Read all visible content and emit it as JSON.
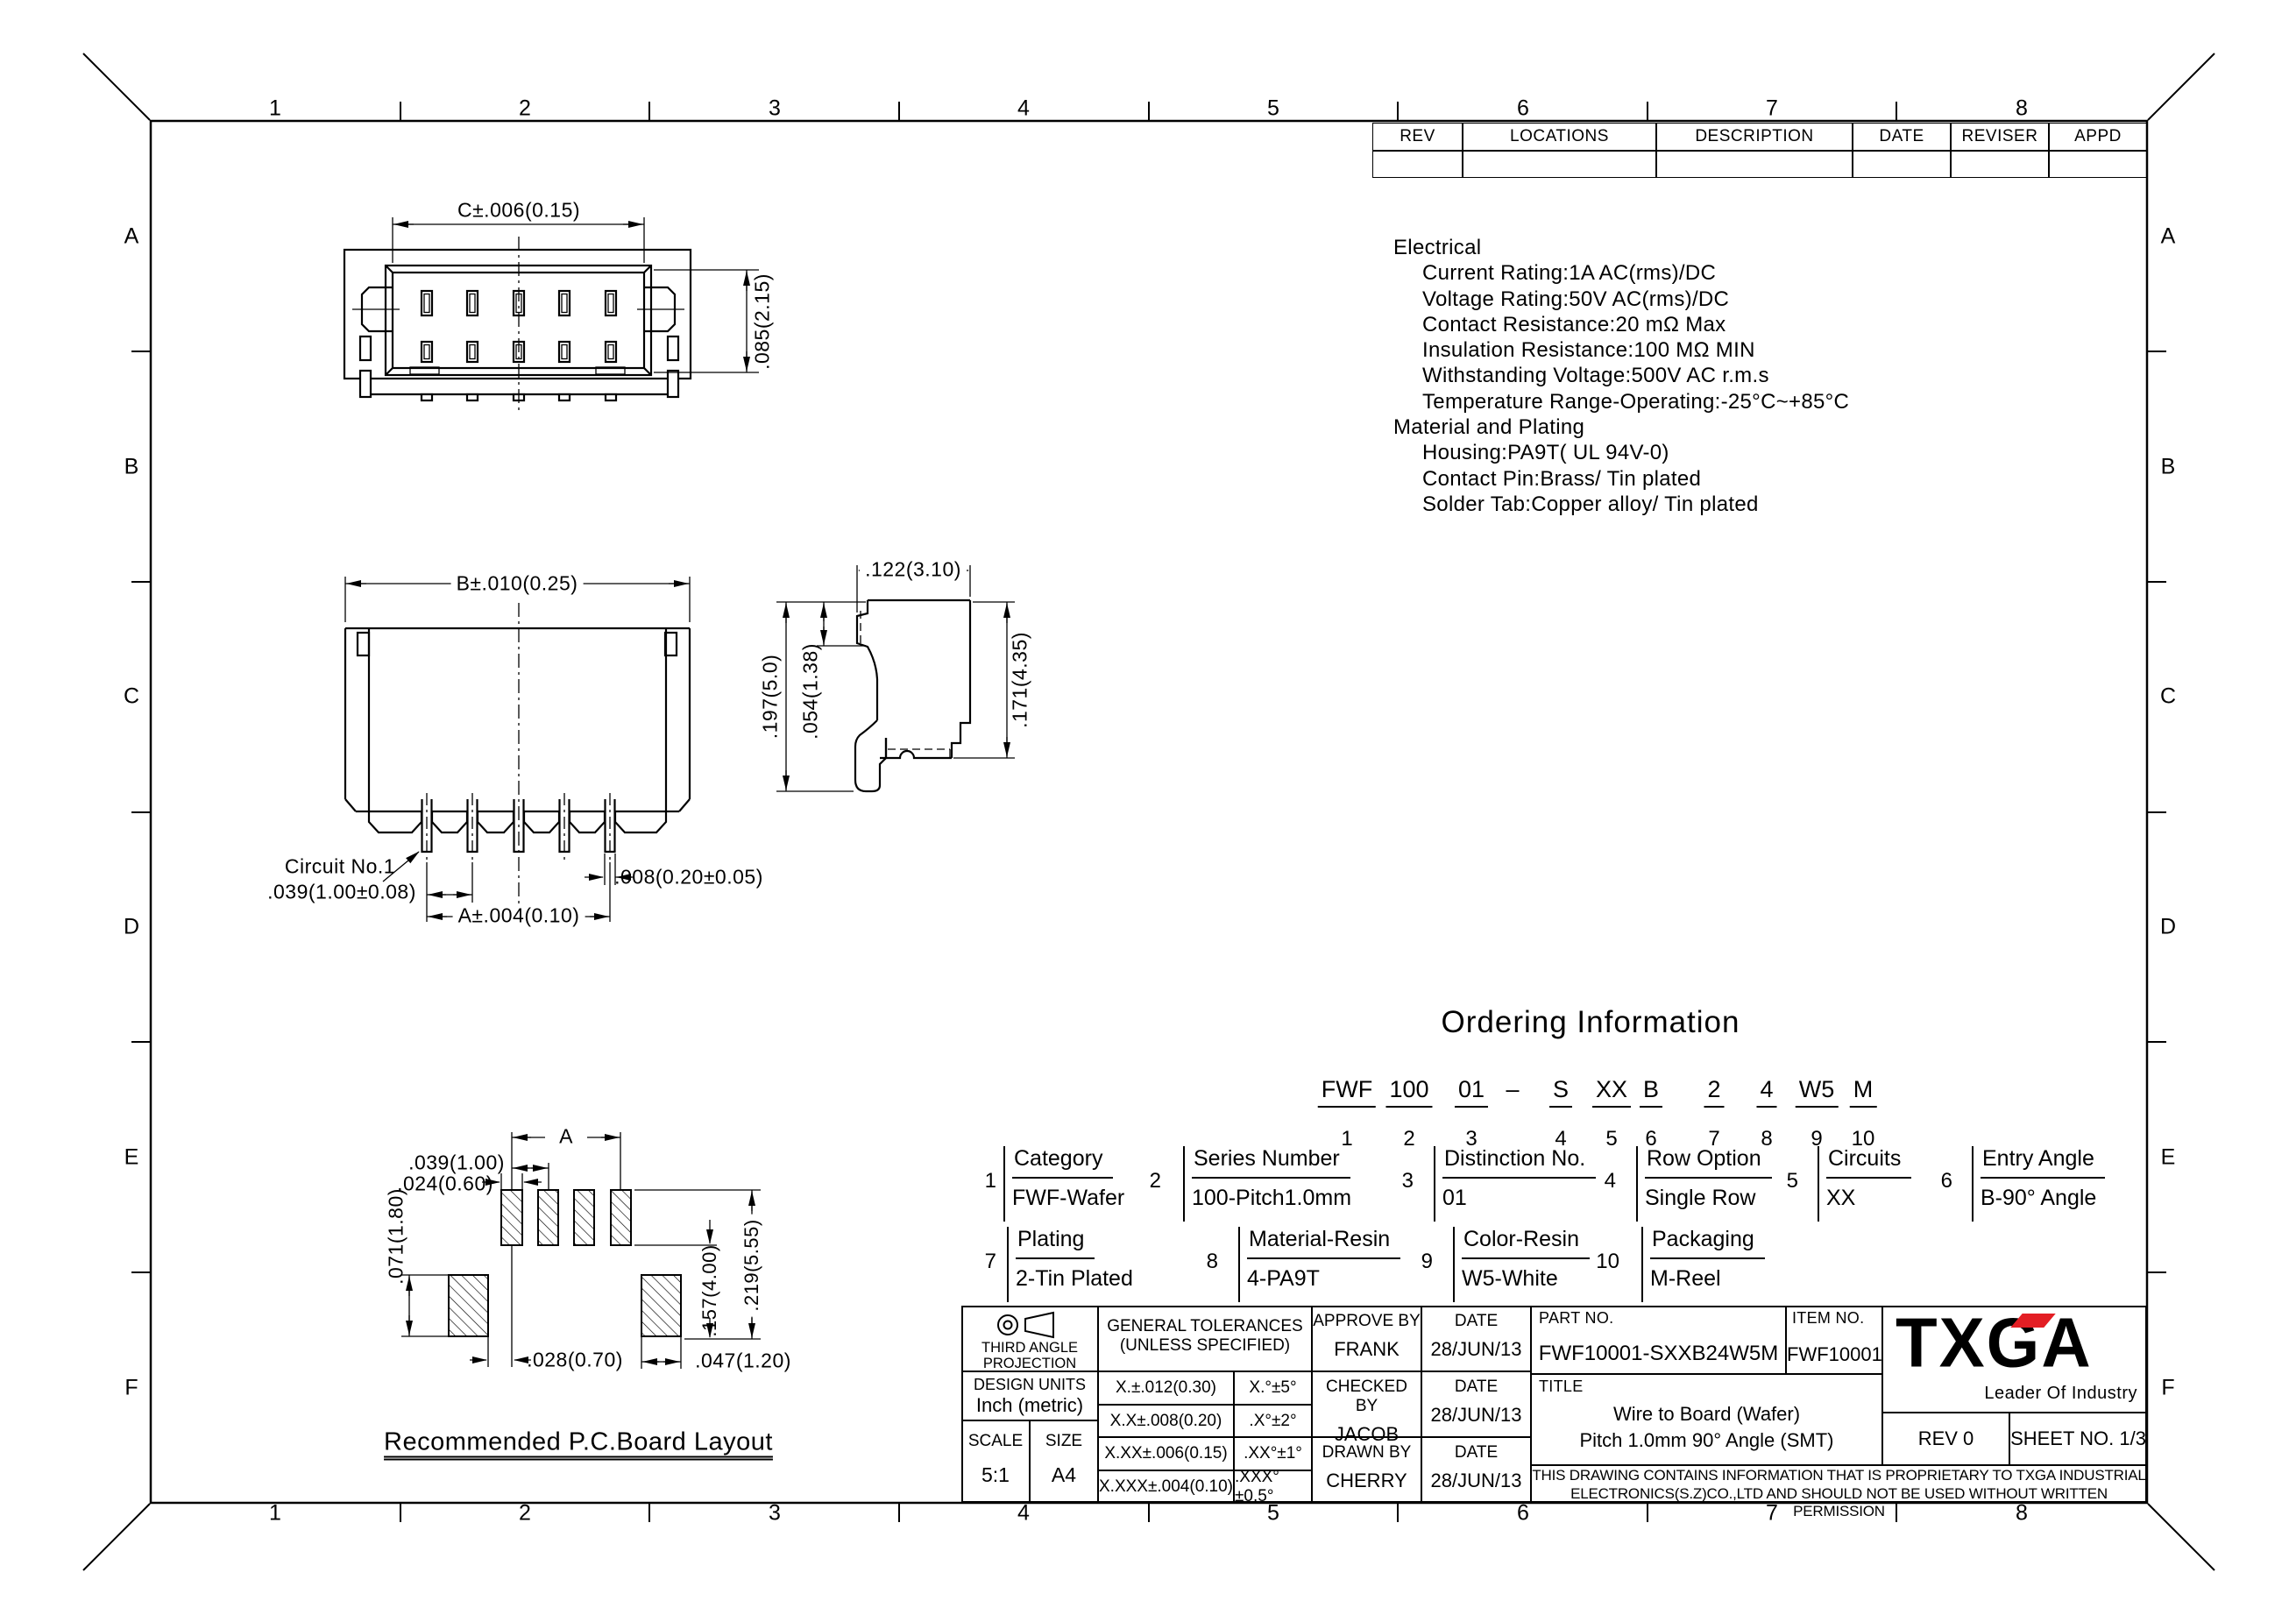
{
  "sheet": {
    "border_columns": [
      "1",
      "2",
      "3",
      "4",
      "5",
      "6",
      "7",
      "8"
    ],
    "border_rows": [
      "A",
      "B",
      "C",
      "D",
      "E",
      "F"
    ]
  },
  "revision_table": {
    "headers": [
      "REV",
      "LOCATIONS",
      "DESCRIPTION",
      "DATE",
      "REVISER",
      "APPD"
    ]
  },
  "specs": {
    "sections": [
      {
        "heading": "Electrical",
        "items": [
          "Current Rating:1A AC(rms)/DC",
          "Voltage Rating:50V AC(rms)/DC",
          "Contact Resistance:20 mΩ Max",
          "Insulation Resistance:100 MΩ MIN",
          "Withstanding Voltage:500V AC r.m.s",
          "Temperature Range-Operating:-25°C~+85°C"
        ]
      },
      {
        "heading": "Material and Plating",
        "items": [
          "Housing:PA9T( UL 94V-0)",
          "Contact Pin:Brass/ Tin plated",
          "Solder Tab:Copper alloy/ Tin plated"
        ]
      }
    ]
  },
  "views": {
    "front_face": {
      "dim_width": "C±.006(0.15)",
      "dim_height": ".085(2.15)"
    },
    "front": {
      "dim_width": "B±.010(0.25)",
      "circuit_label": "Circuit No.1",
      "dim_pitch": ".039(1.00±0.08)",
      "dim_span": "A±.004(0.10)",
      "dim_pin": ".008(0.20±0.05)"
    },
    "side": {
      "dim_depth": ".122(3.10)",
      "dim_height": ".197(5.0)",
      "dim_latch": ".054(1.38)",
      "dim_body": ".171(4.35)"
    },
    "pcb": {
      "title": "Recommended P.C.Board Layout",
      "dim_span": "A",
      "dim_pitch": ".039(1.00)",
      "dim_pad_w": ".024(0.60)",
      "dim_pad_h": ".071(1.80)",
      "dim_h1": ".157(4.00)",
      "dim_h2": ".219(5.55)",
      "dim_off": ".028(0.70)",
      "dim_big_w": ".047(1.20)"
    }
  },
  "ordering": {
    "title": "Ordering Information",
    "code": [
      {
        "seg": "FWF",
        "num": "1"
      },
      {
        "seg": "100",
        "num": "2"
      },
      {
        "seg": "01",
        "num": "3"
      },
      {
        "seg": "–",
        "num": ""
      },
      {
        "seg": "S",
        "num": "4"
      },
      {
        "seg": "XX",
        "num": "5"
      },
      {
        "seg": "B",
        "num": "6"
      },
      {
        "seg": "2",
        "num": "7"
      },
      {
        "seg": "4",
        "num": "8"
      },
      {
        "seg": "W5",
        "num": "9"
      },
      {
        "seg": "M",
        "num": "10"
      }
    ],
    "items": [
      {
        "num": "1",
        "label": "Category",
        "value": "FWF-Wafer"
      },
      {
        "num": "2",
        "label": "Series Number",
        "value": "100-Pitch1.0mm"
      },
      {
        "num": "3",
        "label": "Distinction No.",
        "value": "01"
      },
      {
        "num": "4",
        "label": "Row Option",
        "value": "Single Row"
      },
      {
        "num": "5",
        "label": "Circuits",
        "value": "XX"
      },
      {
        "num": "6",
        "label": "Entry Angle",
        "value": "B-90° Angle"
      },
      {
        "num": "7",
        "label": "Plating",
        "value": "2-Tin Plated"
      },
      {
        "num": "8",
        "label": "Material-Resin",
        "value": "4-PA9T"
      },
      {
        "num": "9",
        "label": "Color-Resin",
        "value": "W5-White"
      },
      {
        "num": "10",
        "label": "Packaging",
        "value": "M-Reel"
      }
    ]
  },
  "title_block": {
    "projection": {
      "caption_l1": "THIRD ANGLE",
      "caption_l2": "PROJECTION"
    },
    "design_units": {
      "label": "DESIGN UNITS",
      "value": "Inch (metric)"
    },
    "scale": {
      "label": "SCALE",
      "value": "5:1"
    },
    "size": {
      "label": "SIZE",
      "value": "A4"
    },
    "tolerances": {
      "header_l1": "GENERAL TOLERANCES",
      "header_l2": "(UNLESS SPECIFIED)",
      "rows": [
        {
          "linear": "X.±.012(0.30)",
          "angular": "X.°±5°"
        },
        {
          "linear": "X.X±.008(0.20)",
          "angular": ".X°±2°"
        },
        {
          "linear": "X.XX±.006(0.15)",
          "angular": ".XX°±1°"
        },
        {
          "linear": "X.XXX±.004(0.10)",
          "angular": ".XXX°±0.5°"
        }
      ]
    },
    "approvals": [
      {
        "label": "APPROVE BY",
        "name": "FRANK",
        "date_label": "DATE",
        "date": "28/JUN/13"
      },
      {
        "label": "CHECKED BY",
        "name": "JACOB",
        "date_label": "DATE",
        "date": "28/JUN/13"
      },
      {
        "label": "DRAWN BY",
        "name": "CHERRY",
        "date_label": "DATE",
        "date": "28/JUN/13"
      }
    ],
    "part_no": {
      "label": "PART NO.",
      "value": "FWF10001-SXXB24W5M"
    },
    "item_no": {
      "label": "ITEM NO.",
      "value": "FWF10001"
    },
    "logo": {
      "text": "TXGA",
      "tagline": "Leader Of Industry"
    },
    "title": {
      "label": "TITLE",
      "line1": "Wire to Board (Wafer)",
      "line2": "Pitch 1.0mm 90° Angle (SMT)"
    },
    "rev": "REV 0",
    "sheet_no": "SHEET NO. 1/3",
    "disclaimer_l1": "THIS DRAWING CONTAINS INFORMATION THAT IS PROPRIETARY TO TXGA INDUSTRIAL",
    "disclaimer_l2": "ELECTRONICS(S.Z)CO.,LTD AND SHOULD NOT BE USED WITHOUT WRITTEN PERMISSION"
  }
}
